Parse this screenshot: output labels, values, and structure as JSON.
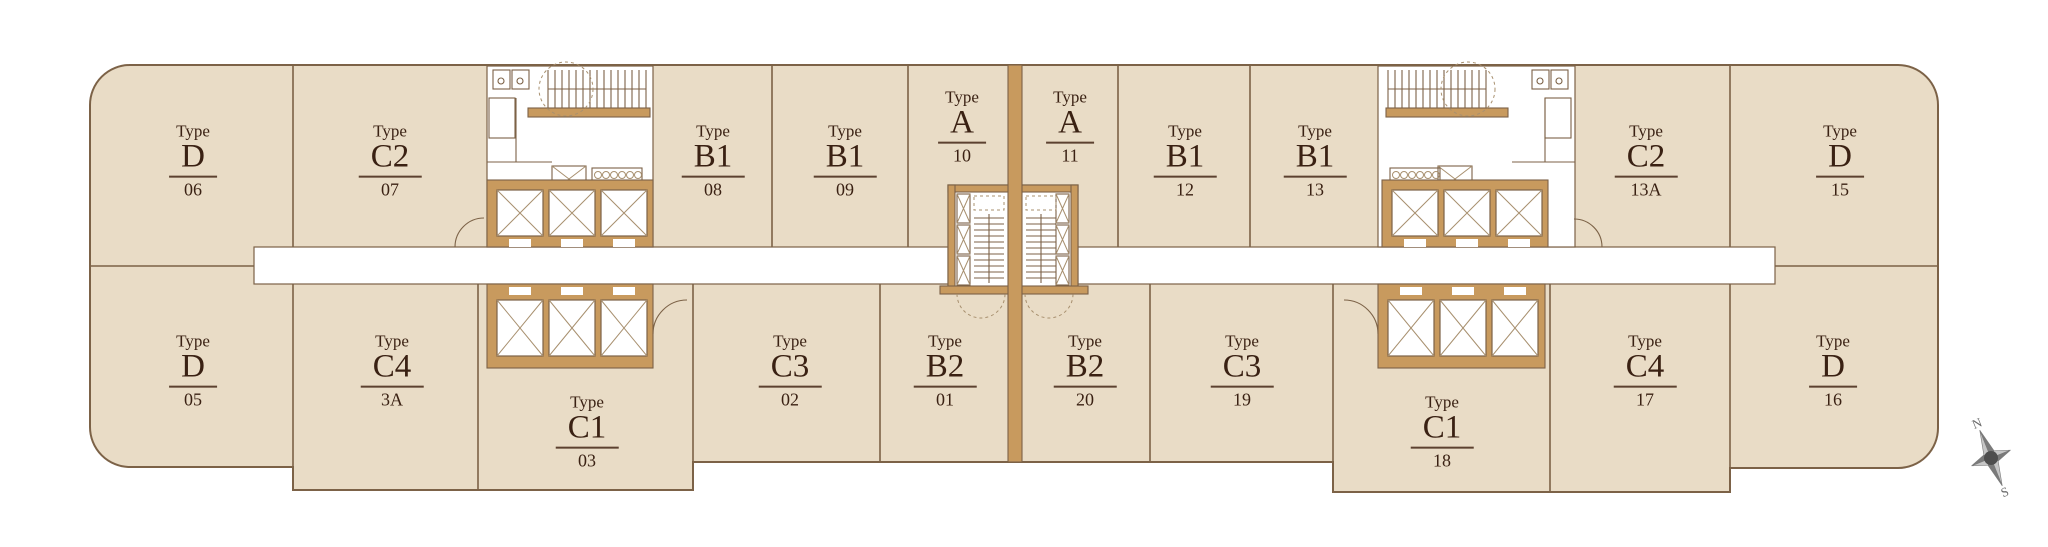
{
  "plan": {
    "type_word": "Type",
    "units": [
      {
        "code": "D",
        "number": "06",
        "cx": 193,
        "cy": 161
      },
      {
        "code": "C2",
        "number": "07",
        "cx": 390,
        "cy": 161
      },
      {
        "code": "B1",
        "number": "08",
        "cx": 713,
        "cy": 161
      },
      {
        "code": "B1",
        "number": "09",
        "cx": 845,
        "cy": 161
      },
      {
        "code": "A",
        "number": "10",
        "cx": 962,
        "cy": 127
      },
      {
        "code": "A",
        "number": "11",
        "cx": 1070,
        "cy": 127
      },
      {
        "code": "B1",
        "number": "12",
        "cx": 1185,
        "cy": 161
      },
      {
        "code": "B1",
        "number": "13",
        "cx": 1315,
        "cy": 161
      },
      {
        "code": "C2",
        "number": "13A",
        "cx": 1646,
        "cy": 161
      },
      {
        "code": "D",
        "number": "15",
        "cx": 1840,
        "cy": 161
      },
      {
        "code": "D",
        "number": "05",
        "cx": 193,
        "cy": 371
      },
      {
        "code": "C4",
        "number": "3A",
        "cx": 392,
        "cy": 371
      },
      {
        "code": "C1",
        "number": "03",
        "cx": 587,
        "cy": 432
      },
      {
        "code": "C3",
        "number": "02",
        "cx": 790,
        "cy": 371
      },
      {
        "code": "B2",
        "number": "01",
        "cx": 945,
        "cy": 371
      },
      {
        "code": "B2",
        "number": "20",
        "cx": 1085,
        "cy": 371
      },
      {
        "code": "C3",
        "number": "19",
        "cx": 1242,
        "cy": 371
      },
      {
        "code": "C1",
        "number": "18",
        "cx": 1442,
        "cy": 432
      },
      {
        "code": "C4",
        "number": "17",
        "cx": 1645,
        "cy": 371
      },
      {
        "code": "D",
        "number": "16",
        "cx": 1833,
        "cy": 371
      }
    ]
  },
  "compass": {
    "north_label": "N",
    "south_label": "S"
  },
  "colors": {
    "unit_fill": "#e9dcc6",
    "wall": "#c89a5e",
    "line": "#7c6247",
    "line_light": "#a8906f",
    "text": "#3a2113",
    "underline": "#5c4130",
    "corridor": "#ffffff",
    "compass_light": "#c6c6c6",
    "compass_dark": "#7a7a7a",
    "compass_center": "#4e4e4e",
    "compass_text": "#6a6a6a"
  }
}
